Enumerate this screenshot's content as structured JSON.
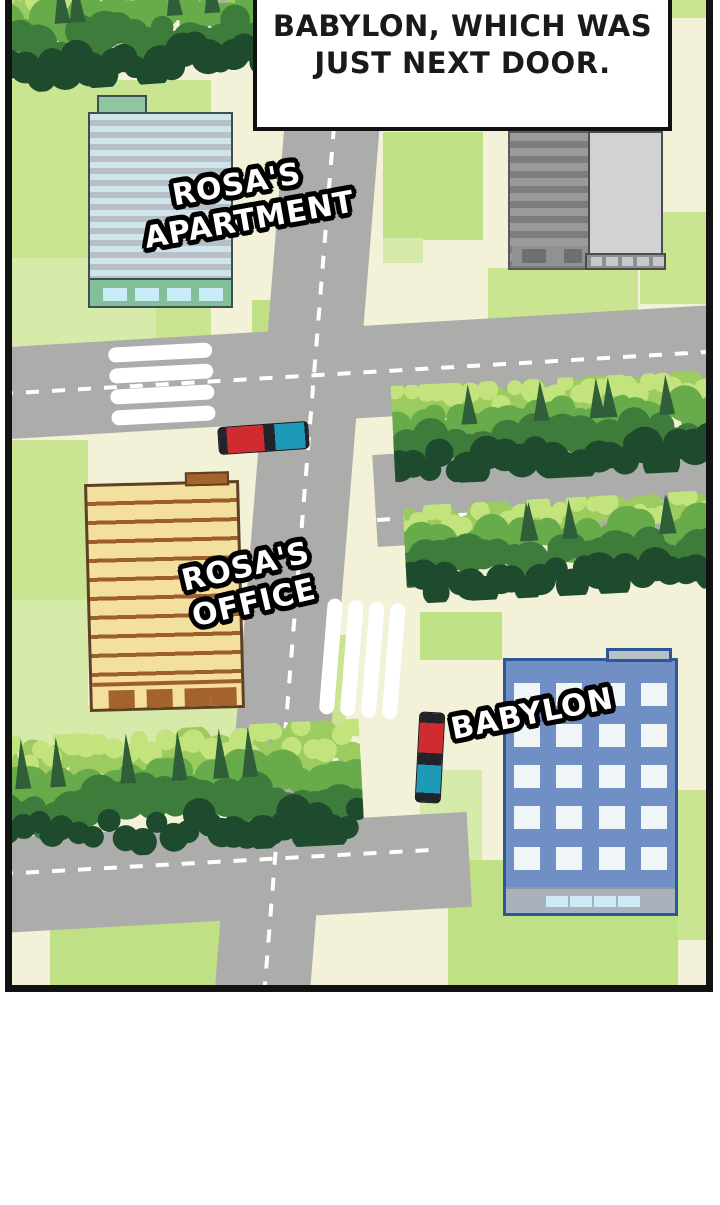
{
  "speech_bubble": {
    "line1": "BABYLON, WHICH WAS",
    "line2": "JUST NEXT DOOR."
  },
  "map": {
    "labels": {
      "apartment": {
        "line1": "ROSA'S",
        "line2": "APARTMENT"
      },
      "office": {
        "line1": "ROSA'S",
        "line2": "OFFICE"
      },
      "babylon": {
        "line1": "BABYLON"
      }
    },
    "colors": {
      "ground": "#f3f1d8",
      "grass": "#c9e592",
      "road": "#acacaa",
      "crosswalk": "#ffffff",
      "bus_red": "#cf2b30",
      "bus_teal": "#1d9ab8",
      "apartment_green": "#8fc6a1",
      "apartment_stripe": "#cfe5ec",
      "office_tan": "#f4e09e",
      "office_brown": "#9d5e2c",
      "babylon_blue": "#7090c5",
      "babylon_border": "#2d5898"
    },
    "vehicles": [
      {
        "name": "bus-horizontal"
      },
      {
        "name": "bus-vertical"
      }
    ]
  }
}
